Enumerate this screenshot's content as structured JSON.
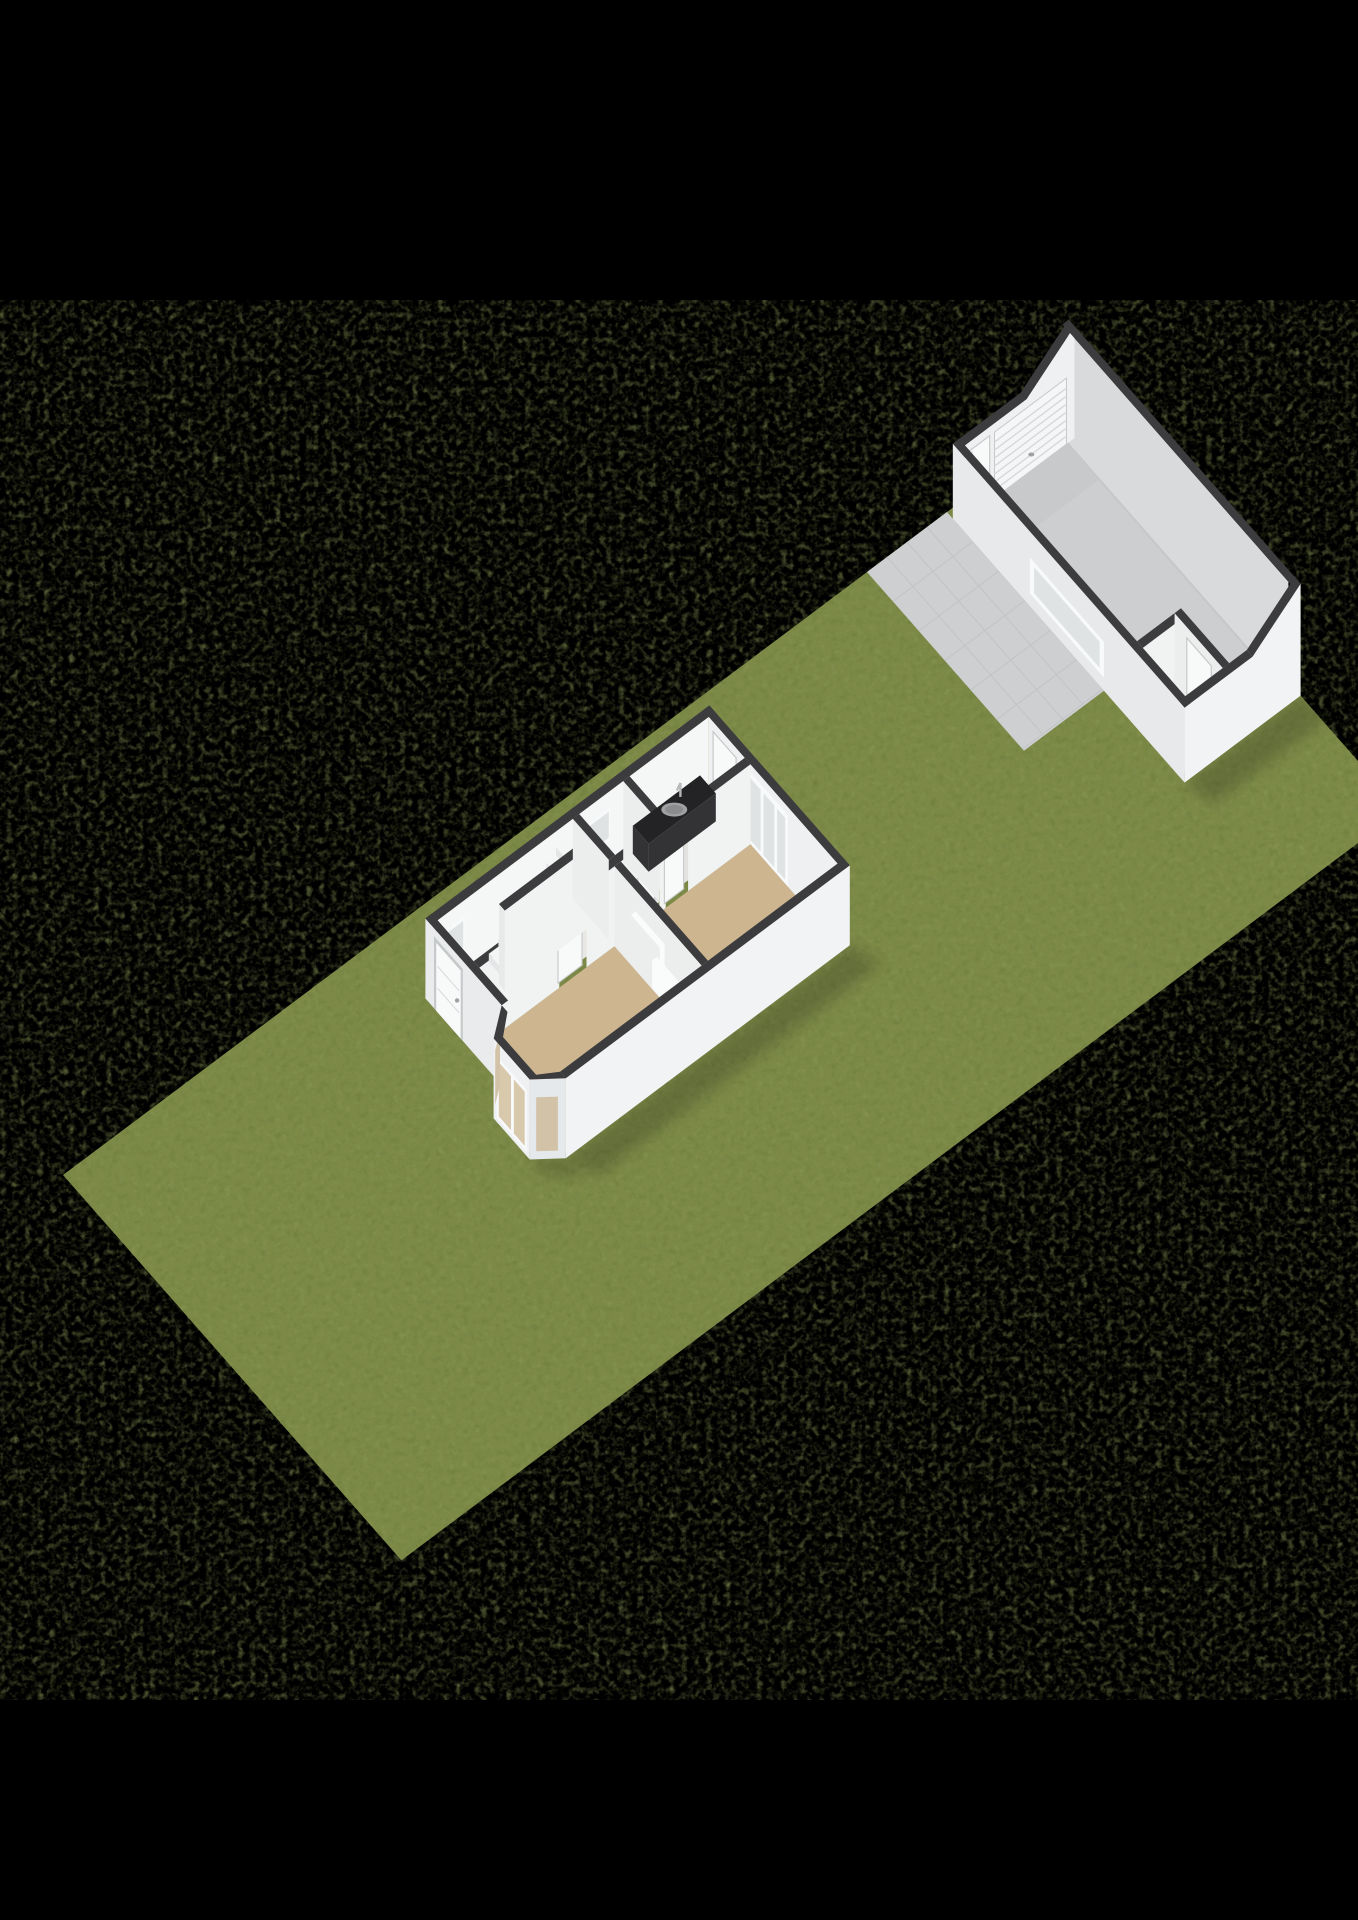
{
  "canvas": {
    "width": 1358,
    "height": 1920,
    "background": "#000000"
  },
  "view": {
    "kind": "isometric-3d-floorplan-render",
    "description": "Ground floor 3D plan on a long garden parcel with detached garage"
  },
  "scene": {
    "parcel": {
      "label": "garden-lawn",
      "features": [
        "lawn",
        "paved-terrace"
      ]
    },
    "house": {
      "label": "main-house",
      "rooms": [
        "hall",
        "staircase",
        "toilet",
        "kitchen",
        "living-room",
        "back-room"
      ],
      "features": [
        "front-door",
        "bay-window",
        "hall-window",
        "toilet-window",
        "kitchen-counter",
        "kitchen-sink",
        "back-door",
        "garden-glazed-doors",
        "radiator-living",
        "radiator-back-room",
        "interior-doors"
      ]
    },
    "garage": {
      "label": "garage",
      "rooms": [
        "garage-bay",
        "storage-room"
      ],
      "features": [
        "sectional-garage-door",
        "side-door",
        "front-window",
        "storage-door",
        "sloped-roof-edge"
      ]
    }
  },
  "colors": {
    "background": "#000000",
    "grass": "#7b8947",
    "grassDark": "#5e6c34",
    "grassLight": "#93a060",
    "pavement": "#cdcfd0",
    "pavementLine": "#c1c3c4",
    "wallTop": "#3c3c3e",
    "outerFront": "#e9ebed",
    "outerSE": "#f1f3f4",
    "outerCant": "#e2e5e7",
    "outerCant2": "#e6e9eb",
    "bayFront": "#eef0f2",
    "innerNW": "#f5f6f6",
    "innerBack": "#eef0f1",
    "partition": "#f1f2f2",
    "partitionSide": "#eceeee",
    "endCap": "#e8eaea",
    "doorWhite": "#f8f9f9",
    "doorFrame": "#c6c9ca",
    "frameWhite": "#f7f9fa",
    "floorHall": "#e8e7e4",
    "floorKitchen": "#e3e2e0",
    "floorWood": "#cdb590",
    "glass": "#dfe3e3",
    "glassBay": "#d9c9ac",
    "glassBaySide": "#d2c3a8",
    "counterTop": "#232325",
    "counterFront": "#333335",
    "sink": "#9fa1a3",
    "sinkInner": "#8a8c8e",
    "metal": "#b5b7b9",
    "knob": "#9ea0a2",
    "garFloor": "#c7c9ca",
    "garFloorSheen": "#d0d2d3",
    "garInnerBack": "#d8dadb",
    "garInnerNW": "#eef0f1",
    "garOuterFront": "#e7e9ea",
    "garOuterSE": "#f1f3f4",
    "garDoor": "#f4f6f7",
    "garDoorSlat": "#d5d8d9",
    "stepTop": "#f4f5f5",
    "stepRiser": "#e3e5e6",
    "radiator": "#fafbfb",
    "shadow": "#000000"
  }
}
